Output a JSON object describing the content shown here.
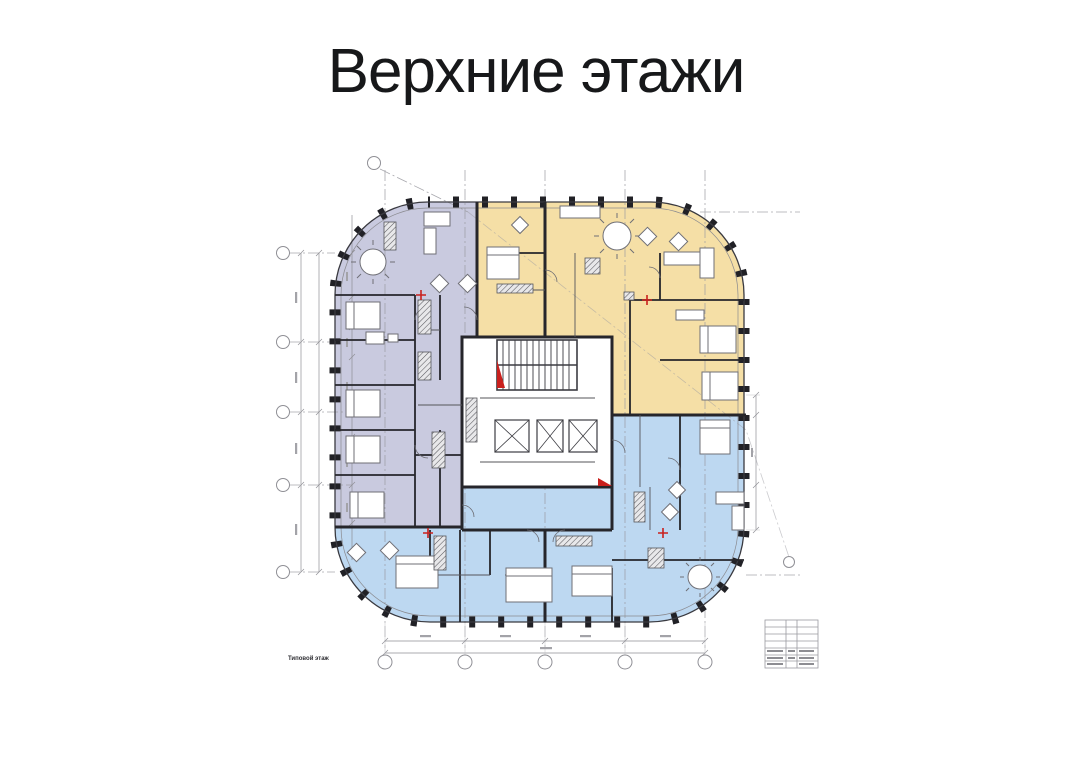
{
  "title": "Верхние этажи",
  "plan": {
    "caption": "Типовой этаж",
    "colors": {
      "west_zone": "#c9cadf",
      "north_east_zone": "#f5dfa6",
      "south_zone": "#bdd8f1",
      "marker_red": "#c9201d",
      "wall": "#26262b",
      "annotation": "#8f8f95"
    },
    "grid": {
      "left_axis_bubbles": 5,
      "bottom_axis_bubbles": 5,
      "top_axis_bubbles": 1,
      "right_axis_bubbles": 1
    },
    "core": {
      "elevator_count": 3,
      "stairwell_count": 1
    },
    "entrance_marker_count": 4
  }
}
